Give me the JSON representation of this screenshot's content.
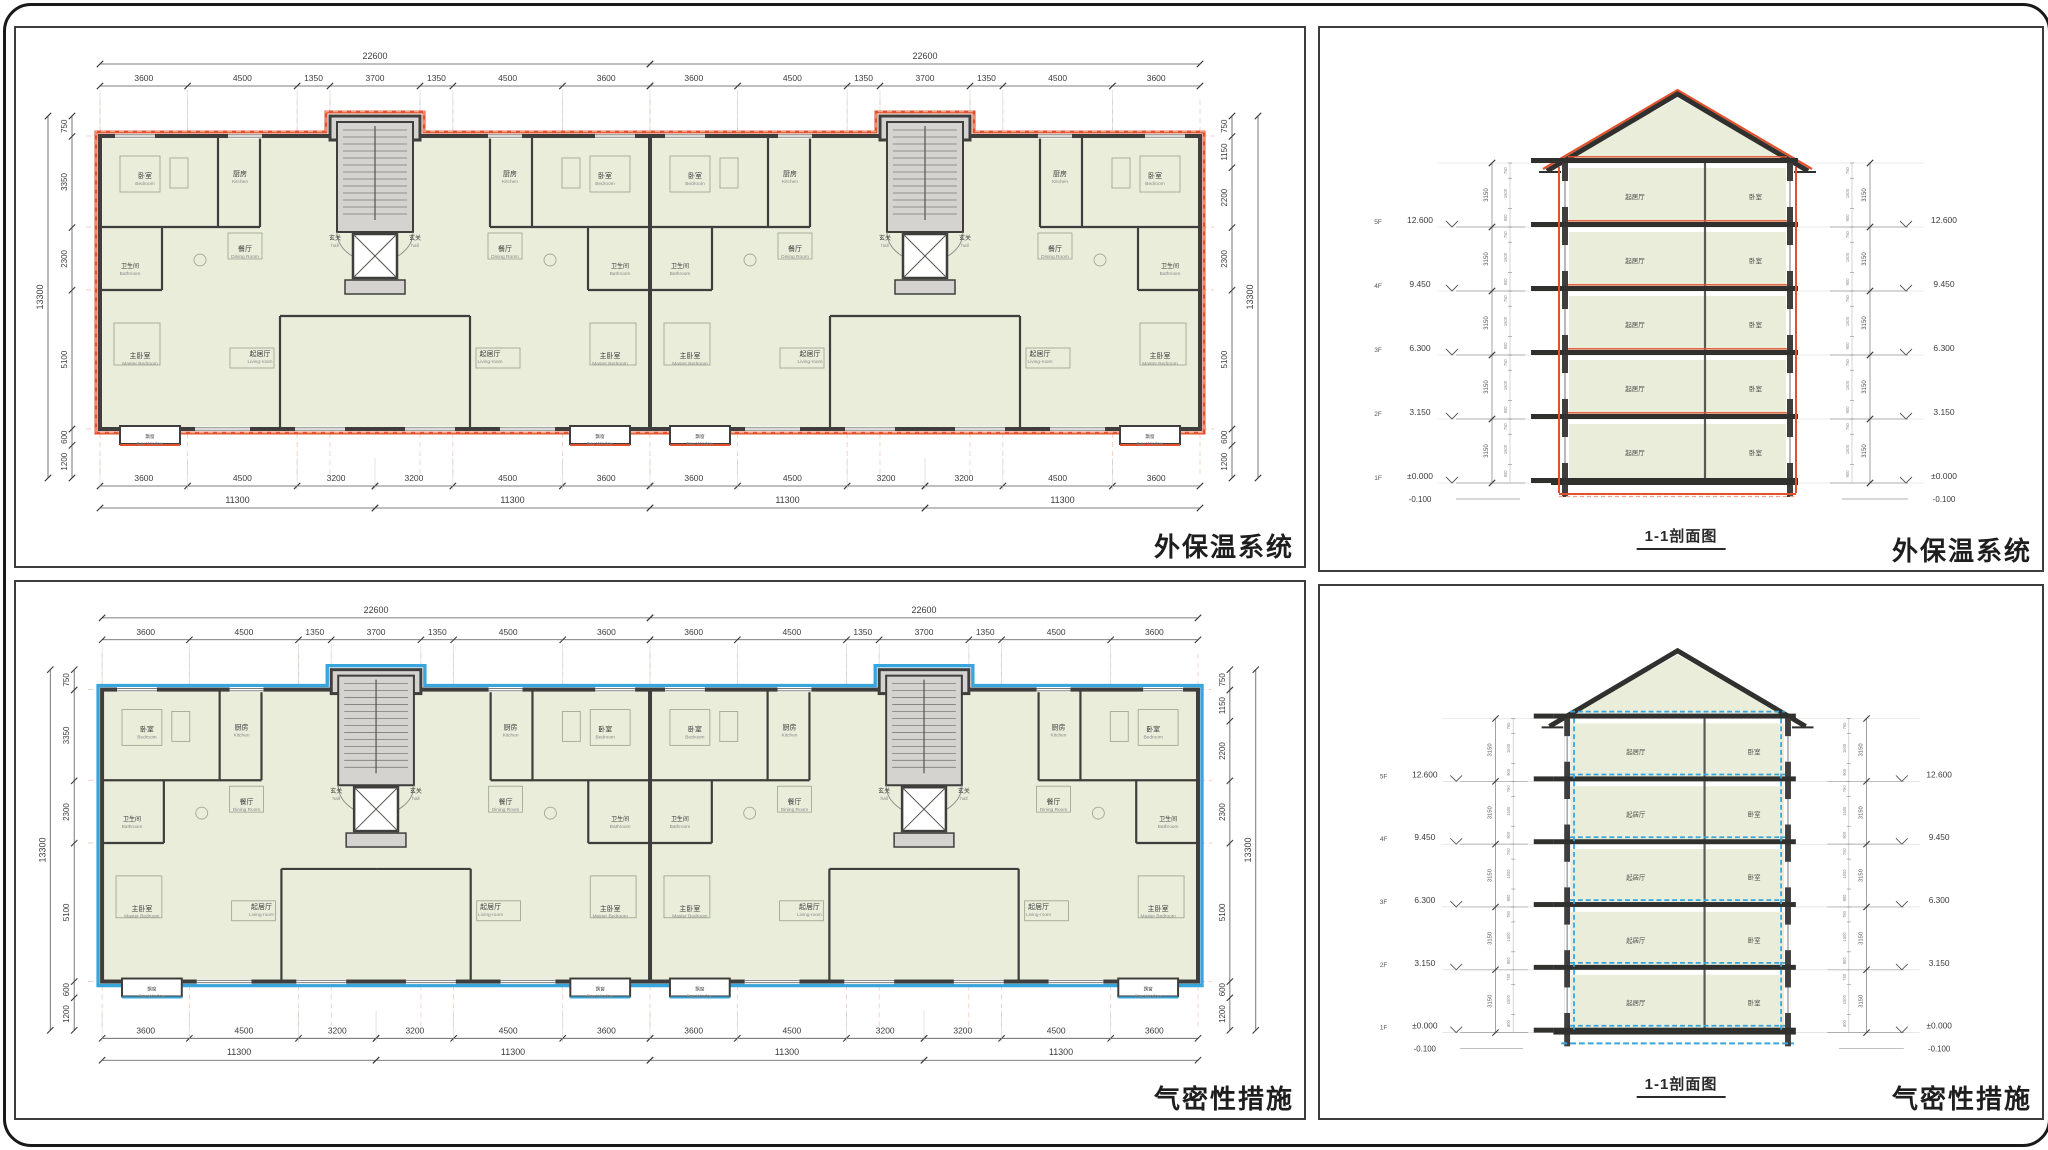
{
  "sheet": {
    "background": "#ffffff",
    "border_color": "#191919"
  },
  "colors": {
    "red_accent": "#e2512c",
    "red_light": "#f2a38c",
    "blue_accent": "#38a5dc",
    "wall": "#3f3e3c",
    "room_fill": "#e9edda",
    "core_fill": "#d4d3d0",
    "dim_line": "#8a8a8a",
    "dim_text": "#3c3c3c"
  },
  "panels": {
    "plan_red": {
      "label": "外保温系统"
    },
    "sec_red": {
      "label": "外保温系统",
      "caption": "1-1剖面图"
    },
    "plan_blue": {
      "label": "气密性措施"
    },
    "sec_blue": {
      "label": "气密性措施",
      "caption": "1-1剖面图"
    }
  },
  "floorplan": {
    "top_total": "22600",
    "top_segments": [
      "3600",
      "4500",
      "1350",
      "3700",
      "1350",
      "4500",
      "3600"
    ],
    "bottom_segments_a": [
      "3600",
      "4500",
      "3200"
    ],
    "bottom_segments_b": [
      "3200",
      "4500",
      "3600"
    ],
    "bottom_total": "11300",
    "left_dims": [
      "750",
      "3350",
      "2300",
      "5100",
      "600",
      "1200"
    ],
    "left_total": "13300",
    "right_dims": [
      "750",
      "1150",
      "2200",
      "2300",
      "5100",
      "600",
      "1200"
    ],
    "right_total": "13300",
    "rooms": {
      "bedroom": {
        "zh": "卧室",
        "en": "Bedroom"
      },
      "kitchen": {
        "zh": "厨房",
        "en": "Kitchen"
      },
      "bathroom": {
        "zh": "卫生间",
        "en": "Bathroom"
      },
      "dining": {
        "zh": "餐厅",
        "en": "Dining Room"
      },
      "living": {
        "zh": "起居厅",
        "en": "Living-room"
      },
      "master": {
        "zh": "主卧室",
        "en": "Master Bedroom"
      },
      "hall": {
        "zh": "玄关",
        "en": "hall"
      },
      "baywindow": {
        "zh": "飘窗",
        "en": "Bay Window"
      }
    }
  },
  "section": {
    "caption": "1-1剖面图",
    "floors": [
      {
        "name": "1F",
        "elev": "±0.000"
      },
      {
        "name": "2F",
        "elev": "3.150"
      },
      {
        "name": "3F",
        "elev": "6.300"
      },
      {
        "name": "4F",
        "elev": "9.450"
      },
      {
        "name": "5F",
        "elev": "12.600"
      }
    ],
    "below_grade": "-0.100",
    "floor_height": "3150",
    "window_dims": [
      "750",
      "1500",
      "900"
    ],
    "room_left": "起居厅",
    "room_right": "卧室"
  }
}
